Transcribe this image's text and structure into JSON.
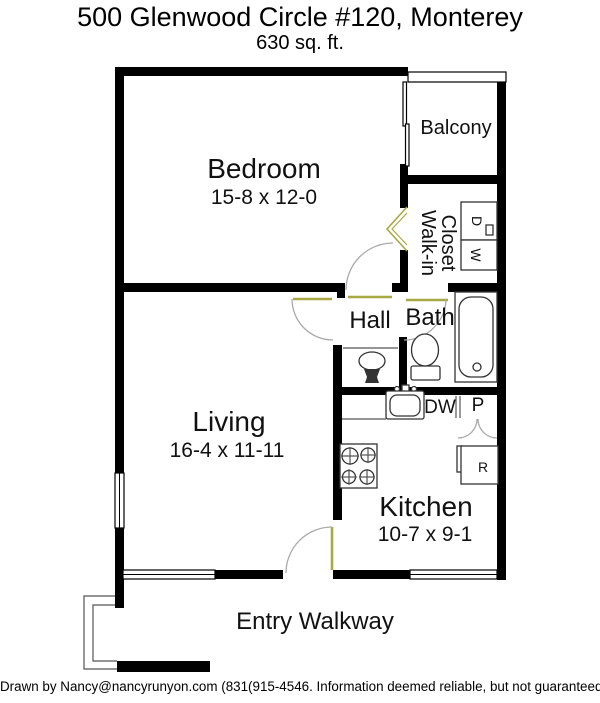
{
  "header": {
    "title": "500 Glenwood Circle #120, Monterey",
    "subtitle": "630 sq. ft."
  },
  "rooms": {
    "bedroom": {
      "name": "Bedroom",
      "dims": "15-8 x 12-0"
    },
    "living": {
      "name": "Living",
      "dims": "16-4 x 11-11"
    },
    "kitchen": {
      "name": "Kitchen",
      "dims": "10-7 x 9-1"
    },
    "hall": {
      "name": "Hall"
    },
    "bath": {
      "name": "Bath"
    },
    "balcony": {
      "name": "Balcony"
    },
    "closet": {
      "line1": "Walk-in",
      "line2": "Closet"
    },
    "entry": {
      "name": "Entry Walkway"
    }
  },
  "appliances": {
    "dryer": "D",
    "washer": "W",
    "dishwasher": "DW",
    "pantry": "P",
    "refrigerator": "R"
  },
  "footer": {
    "credit": "Drawn by Nancy@nancyrunyon.com (831(915-4546. Information deemed reliable, but not guaranteed."
  },
  "colors": {
    "walls": "#000000",
    "door_accent": "#A8A845",
    "swing_arc": "#AAAAAA",
    "fixture_outline": "#333333",
    "background": "#FFFFFF"
  }
}
